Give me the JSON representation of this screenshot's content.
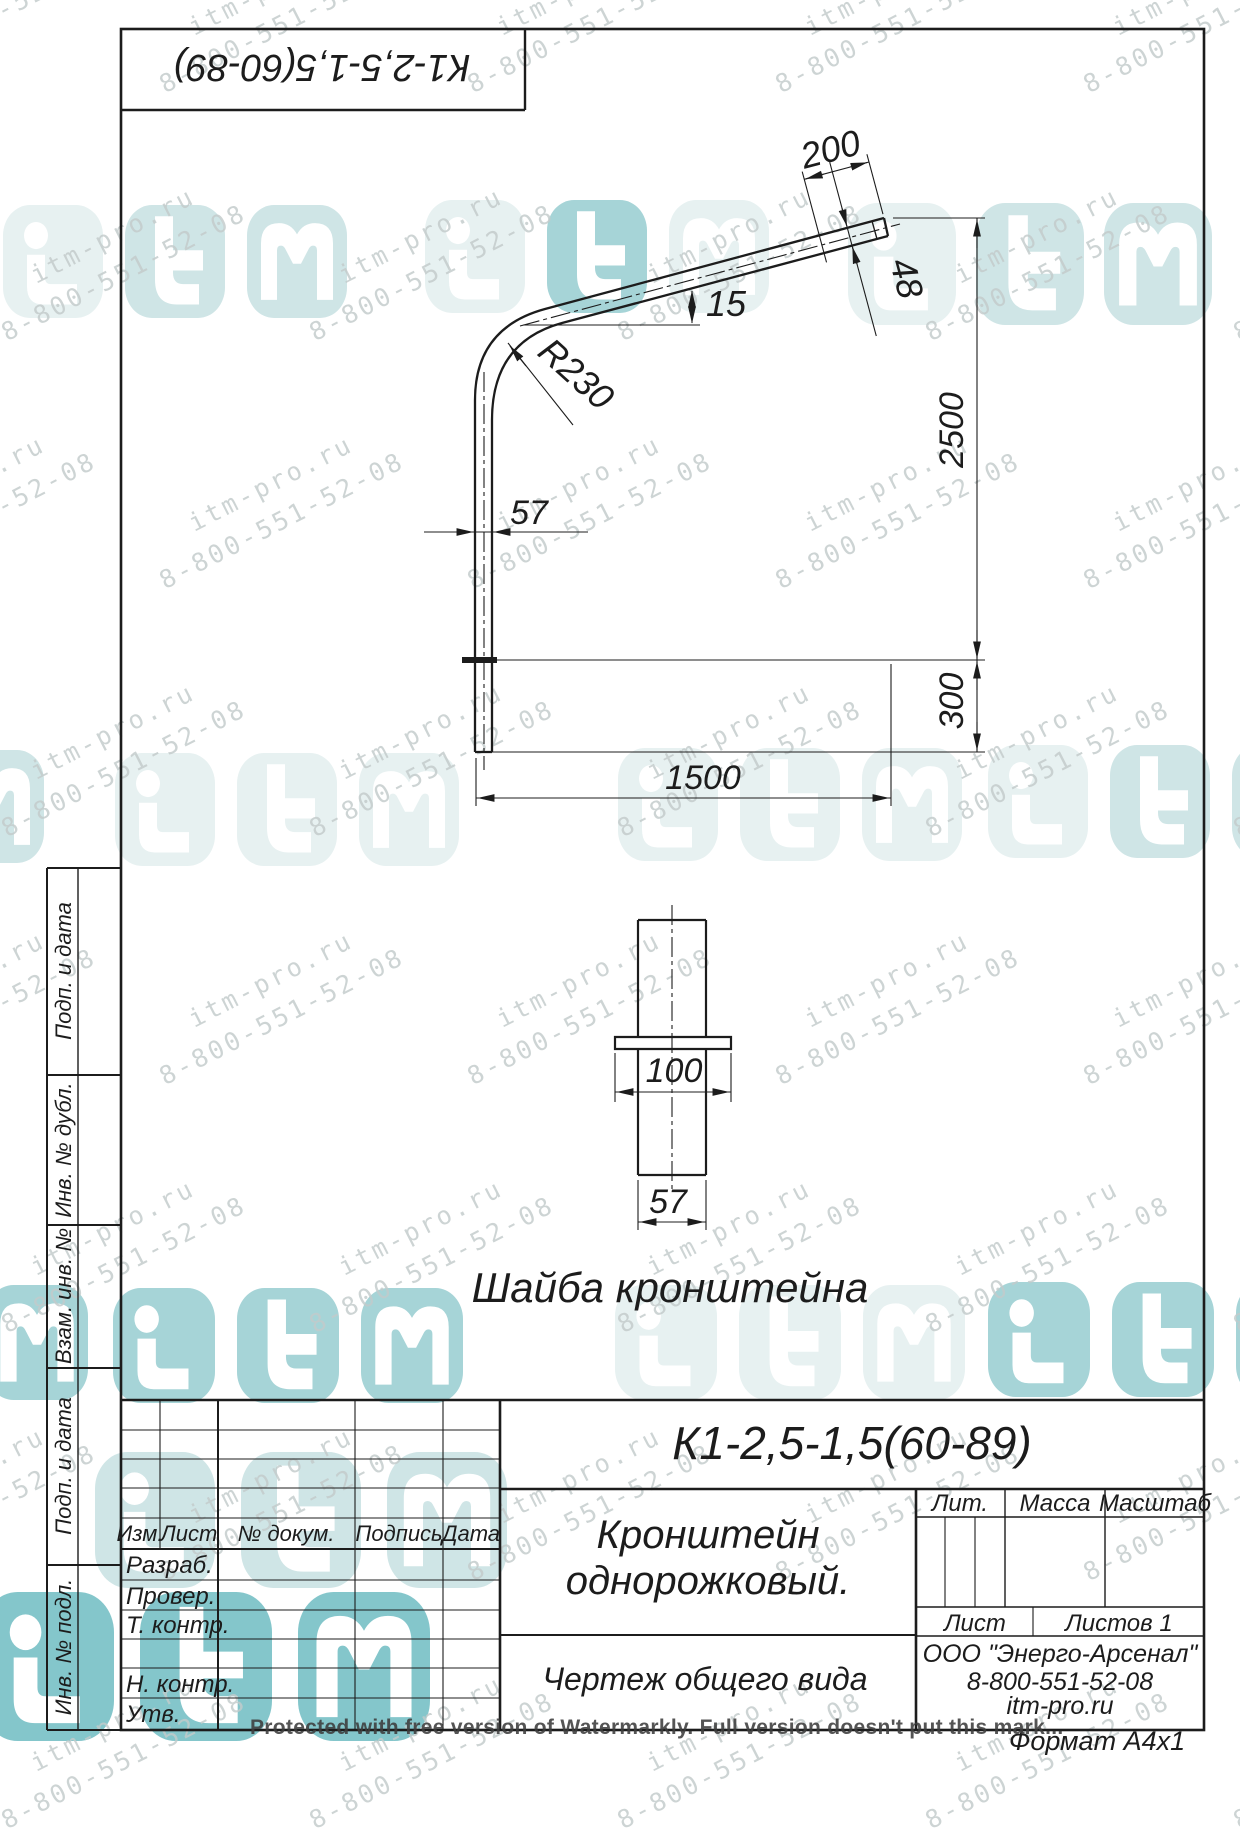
{
  "page": {
    "width": 1240,
    "height": 1755,
    "background": "#ffffff"
  },
  "colors": {
    "line": "#1c1c1c",
    "wm_text": "#c3cbcb",
    "teal_light": "#e7f1f1",
    "teal_mid": "#cfe5e6",
    "teal_strong": "#a6d4d7",
    "teal_deep": "#84c6cb"
  },
  "top_box": {
    "designation": "К1-2,5-1,5(60-89)"
  },
  "main_view": {
    "dims": {
      "d200": "200",
      "d48": "48",
      "angle": "15",
      "radius": "R230",
      "d57": "57",
      "d2500": "2500",
      "d300": "300",
      "d1500": "1500"
    }
  },
  "washer_view": {
    "dims": {
      "d100": "100",
      "d57": "57"
    },
    "caption": "Шайба кронштейна"
  },
  "side_strip": {
    "labels": [
      {
        "label": "Подп. и дата"
      },
      {
        "label": "Инв. № дубл."
      },
      {
        "label": "Взам. инв. №"
      },
      {
        "label": "Подп. и дата"
      },
      {
        "label": "Инв. № подл."
      }
    ]
  },
  "title_block": {
    "designation": "К1-2,5-1,5(60-89)",
    "name_line1": "Кронштейн",
    "name_line2": "однорожковый.",
    "doc_type": "Чертеж общего вида",
    "header": {
      "izm": "Изм.",
      "list": "Лист",
      "doc": "№ докум.",
      "sign": "Подпись",
      "date": "Дата"
    },
    "rows": {
      "razrab": "Разраб.",
      "prover": "Провер.",
      "tkontr": "Т. контр.",
      "nkontr": "Н. контр.",
      "utv": "Утв."
    },
    "lit": "Лит.",
    "mass": "Масса",
    "scale": "Масштаб",
    "sheet": "Лист",
    "sheets": "Листов 1",
    "company_line1": "ООО \"Энерго-Арсенал\"",
    "company_line2": "8-800-551-52-08",
    "company_line3": "itm-pro.ru",
    "format": "Формат А4х1"
  },
  "watermark": {
    "line1": "itm-pro.ru",
    "line2": "8-800-551-52-08",
    "protected_text": "Protected with free version of Watermarkly. Full version doesn't put this mark..."
  }
}
